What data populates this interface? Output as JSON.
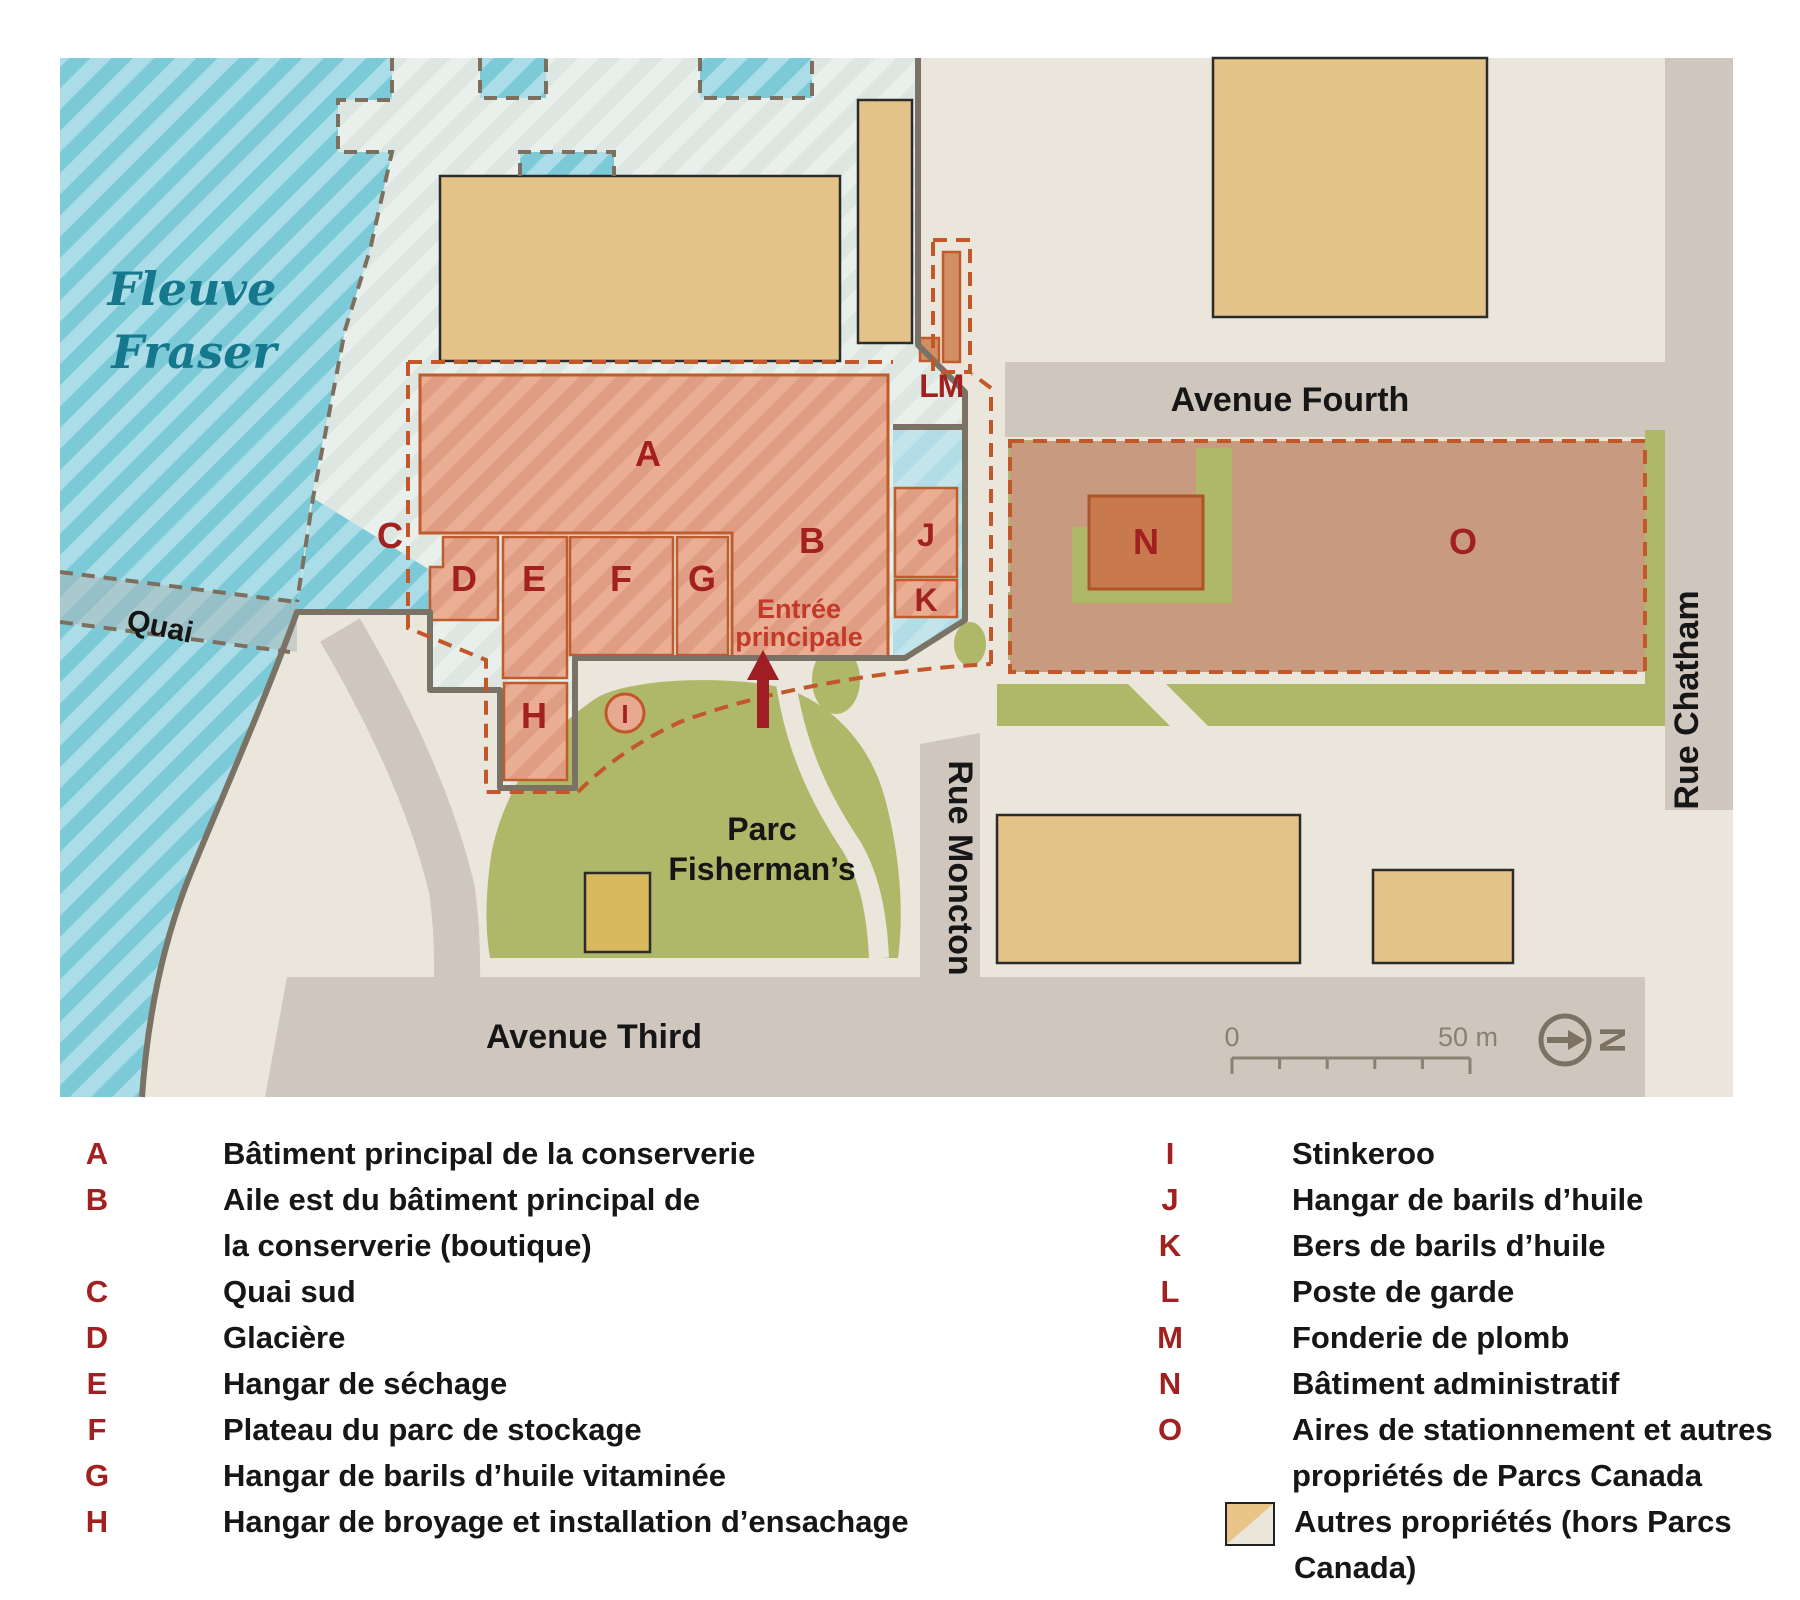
{
  "colors": {
    "water_stripe": "#7CCAD8",
    "water_light": "#ABDDE8",
    "intertidal": "#DDE6E1",
    "land": "#EAE6DC",
    "street": "#CFC7BD",
    "cannery_fill": "#E9AE94",
    "cannery_border": "#C05B2B",
    "other_property": "#E4C388",
    "park_green": "#AFB768",
    "parking_area": "#C89B81",
    "letter_red": "#A32020",
    "river_teal": "#15788C",
    "arrow_red": "#9E1E24"
  },
  "map": {
    "river": {
      "line1": "Fleuve",
      "line2": "Fraser"
    },
    "quai": "Quai",
    "streets": {
      "fourth": "Avenue Fourth",
      "third": "Avenue Third",
      "chatham": "Rue Chatham",
      "moncton": "Rue Moncton"
    },
    "park": {
      "line1": "Parc",
      "line2": "Fisherman’s"
    },
    "entrance": {
      "line1": "Entrée",
      "line2": "principale"
    },
    "letters": {
      "a": "A",
      "b": "B",
      "c": "C",
      "d": "D",
      "e": "E",
      "f": "F",
      "g": "G",
      "h": "H",
      "i": "I",
      "j": "J",
      "k": "K",
      "l": "L",
      "m": "M",
      "n": "N",
      "o": "O"
    },
    "scale": {
      "start": "0",
      "end": "50 m"
    },
    "north": "N"
  },
  "legend": {
    "left": [
      {
        "letter": "A",
        "text": "Bâtiment principal de la conserverie"
      },
      {
        "letter": "B",
        "text": "Aile est du bâtiment principal de",
        "text2": "la conserverie (boutique)"
      },
      {
        "letter": "C",
        "text": "Quai sud"
      },
      {
        "letter": "D",
        "text": "Glacière"
      },
      {
        "letter": "E",
        "text": "Hangar de séchage"
      },
      {
        "letter": "F",
        "text": "Plateau du parc de stockage"
      },
      {
        "letter": "G",
        "text": "Hangar de barils d’huile vitaminée"
      },
      {
        "letter": "H",
        "text": "Hangar de broyage et installation d’ensachage"
      }
    ],
    "right": [
      {
        "letter": "I",
        "text": "Stinkeroo"
      },
      {
        "letter": "J",
        "text": "Hangar de barils d’huile"
      },
      {
        "letter": "K",
        "text": "Bers de barils d’huile"
      },
      {
        "letter": "L",
        "text": "Poste de garde"
      },
      {
        "letter": "M",
        "text": "Fonderie de plomb"
      },
      {
        "letter": "N",
        "text": "Bâtiment administratif"
      },
      {
        "letter": "O",
        "text": "Aires de stationnement et autres",
        "text2": "propriétés de Parcs Canada"
      }
    ],
    "other": {
      "text": "Autres propriétés (hors Parcs Canada)"
    }
  }
}
